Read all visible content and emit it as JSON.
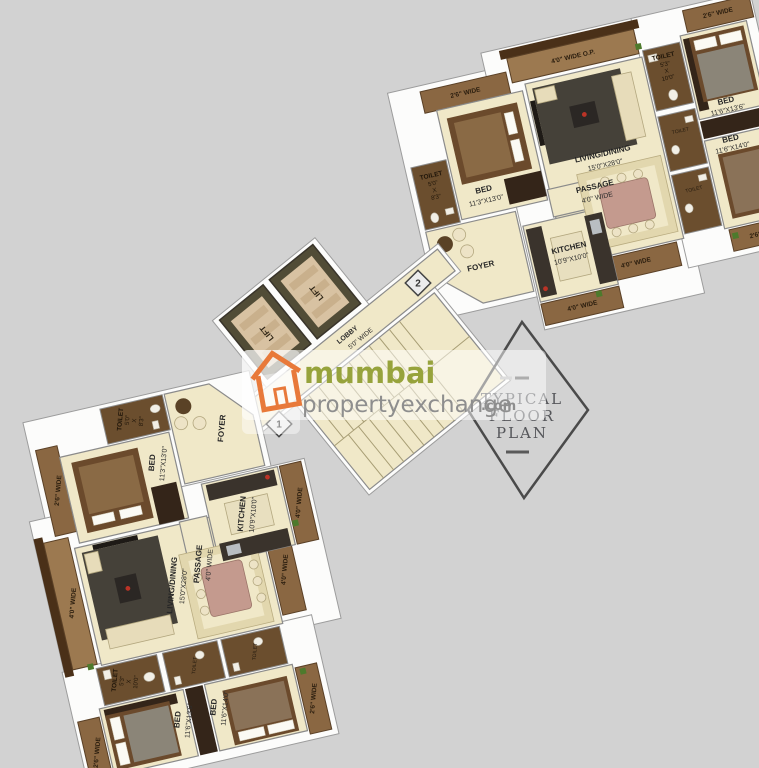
{
  "background": {
    "color": "#d2d2d2"
  },
  "watermark": {
    "brand_primary": "mumbai",
    "brand_secondary": "propertyexchange",
    "brand_tld": ".com",
    "colors": {
      "primary_green": "#97a33c",
      "secondary_gray": "#8e8e8e",
      "house_orange": "#e8793a"
    }
  },
  "stamp": {
    "line1": "TYPICAL",
    "line2": "FLOOR",
    "line3": "PLAN"
  },
  "core": {
    "lift_label": "LIFT",
    "lobby_label": "LOBBY",
    "lobby_dims": "5'0\" WIDE",
    "markers": {
      "unit1": "1",
      "unit2": "2"
    }
  },
  "rooms": {
    "foyer": {
      "name": "FOYER"
    },
    "passage": {
      "name": "PASSAGE",
      "dims": "4'0\" WIDE"
    },
    "kitchen": {
      "name": "KITCHEN",
      "dims": "10'9\"X10'0\""
    },
    "living": {
      "name": "LIVING/DINING",
      "dims": "15'0\"X28'0\""
    },
    "bed1": {
      "name": "BED",
      "dims": "11'3\"X13'0\""
    },
    "bed2": {
      "name": "BED",
      "dims": "11'6\"X13'6\""
    },
    "bed3": {
      "name": "BED",
      "dims": "11'6\"X14'0\""
    },
    "toilet1": {
      "name": "TOILET",
      "w": "5'0\"",
      "x": "X",
      "l": "8'3\""
    },
    "toilet2": {
      "name": "TOILET",
      "w": "5'3\"",
      "x": "X",
      "l": "10'0\""
    },
    "toilet_small": {
      "name": "TOILET"
    },
    "balcony_26": "2'6\" WIDE",
    "balcony_40": "4'0\" WIDE",
    "terrace_op": "4'0\" WIDE O.P."
  },
  "palette": {
    "floor_cream": "#f0e8c8",
    "balcony_wood": "#8a6742",
    "dark_floor": "#6b4e2e",
    "wall_white": "#fcfcfb"
  }
}
